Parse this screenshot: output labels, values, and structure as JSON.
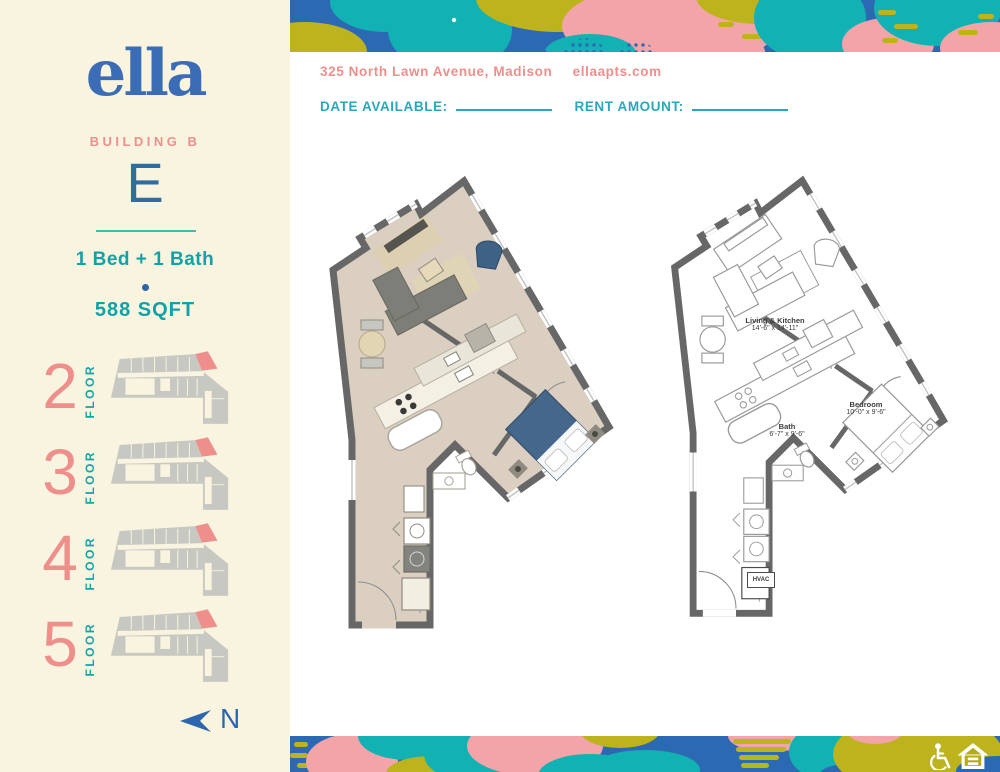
{
  "sidebar": {
    "logo_text": "ella",
    "building_label": "BUILDING B",
    "unit_letter": "E",
    "bed_bath": "1 Bed + 1 Bath",
    "sqft": "588 SQFT",
    "floor_word": "FLOOR",
    "floors": [
      {
        "number": "2"
      },
      {
        "number": "3"
      },
      {
        "number": "4"
      },
      {
        "number": "5"
      }
    ],
    "north_label": "N"
  },
  "header": {
    "address": "325 North Lawn Avenue, Madison",
    "website": "ellaapts.com",
    "date_available_label": "DATE AVAILABLE:",
    "date_available_value": "",
    "rent_amount_label": "RENT AMOUNT:",
    "rent_amount_value": ""
  },
  "floorplans": {
    "labels": {
      "living": {
        "name": "Living & Kitchen",
        "dims": "14'-6\" x 14'-11\""
      },
      "bedroom": {
        "name": "Bedroom",
        "dims": "10'-0\" x 9'-6\""
      },
      "bath": {
        "name": "Bath",
        "dims": "6'-7\" x 9'-6\""
      },
      "hvac": "HVAC"
    }
  },
  "colors": {
    "brand_blue": "#3b6cb6",
    "salmon": "#ee8f8c",
    "teal": "#12a1a8",
    "header_teal": "#2ba7bd",
    "cream": "#f8f4df",
    "banner_blue": "#2b6ab3",
    "banner_teal": "#12b1b3",
    "banner_pink": "#f3a4a9",
    "banner_olive": "#bdb41d",
    "wall_gray": "#676767",
    "floor_tan": "#dacfc0"
  }
}
